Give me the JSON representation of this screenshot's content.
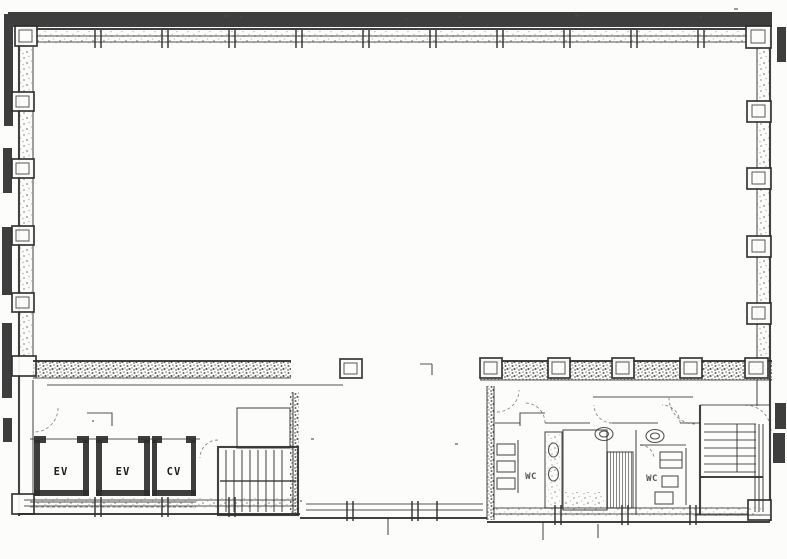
{
  "document": {
    "kind": "scanned-building-floor-plan",
    "colors": {
      "background": "#fcfcfb",
      "ink": "#2e2e2e",
      "scan_band": "#3e3e3e",
      "speckle": "#4a4a4a"
    }
  },
  "labels": {
    "elevators": [
      {
        "id": "elevator-1",
        "text": "EV"
      },
      {
        "id": "elevator-2",
        "text": "EV"
      },
      {
        "id": "elevator-3",
        "text": "CV"
      }
    ],
    "restrooms": [
      {
        "id": "wc-left",
        "text": "WC"
      },
      {
        "id": "wc-right",
        "text": "WC"
      }
    ]
  }
}
